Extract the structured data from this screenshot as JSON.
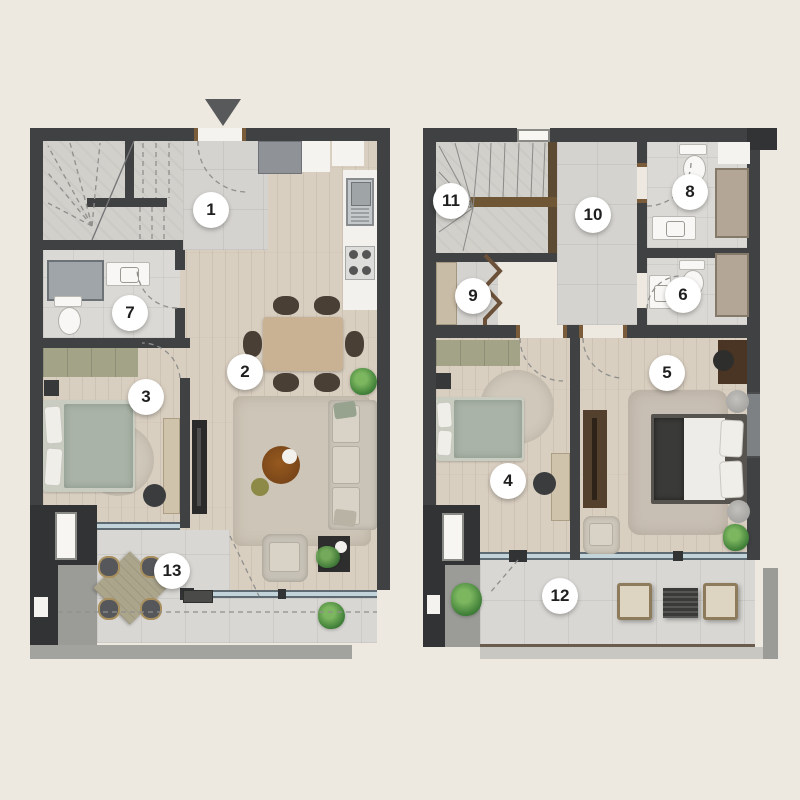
{
  "title": "Duplex apartment floor plans (two levels, rooms numbered 1-13)",
  "colors": {
    "background": "#EDE8E0",
    "wall": "#3F4142",
    "wall_dark": "#323335",
    "wood_floor": "#D9CFC1",
    "tile_floor": "#D5D3CF",
    "terrace_floor": "#D8D7D3",
    "window_glass": "#C2D3D9",
    "door_jamb_brown": "#7A5B3A",
    "stair_rail_brown": "#6F5635",
    "wardrobe_olive": "#A3A387",
    "bed_sage": "#A9B3A7",
    "plant_green": "#3F7E38",
    "badge_bg": "#FFFFFF",
    "badge_text": "#1F1F1F",
    "ledge_grey": "#A2A29E"
  },
  "entrance": {
    "marker_icon": "down-arrow"
  },
  "badges": {
    "r1": "1",
    "r2": "2",
    "r3": "3",
    "r4": "4",
    "r5": "5",
    "r6": "6",
    "r7": "7",
    "r8": "8",
    "r9": "9",
    "r10": "10",
    "r11": "11",
    "r12": "12",
    "r13": "13"
  },
  "plans": {
    "lower": {
      "id": "lower-floor-plan",
      "room_numbers": [
        "1",
        "2",
        "3",
        "7",
        "13"
      ],
      "features": [
        "entrance-arrow",
        "staircase-dashed",
        "entry-hall",
        "kitchen-counter",
        "kitchen-sink",
        "kitchen-hob",
        "entry-cabinet",
        "bathroom-shower",
        "bathroom-sink",
        "toilet",
        "dining-table-6-chairs",
        "sofa",
        "coffee-table",
        "armchair",
        "side-table",
        "tv-console",
        "wardrobe",
        "single-bed",
        "round-rug",
        "area-rug",
        "desk",
        "desk-chair",
        "balcony-table-4-chairs",
        "plants",
        "windows"
      ]
    },
    "upper": {
      "id": "upper-floor-plan",
      "room_numbers": [
        "4",
        "5",
        "6",
        "8",
        "9",
        "10",
        "11",
        "12"
      ],
      "features": [
        "staircase-solid",
        "stair-railing",
        "hallway",
        "closet-rod-zigzag",
        "closet-cabinet",
        "two-bathrooms",
        "toilets",
        "showers",
        "sinks",
        "wardrobe",
        "single-bed",
        "double-bed",
        "round-rug",
        "area-rug",
        "tv-console",
        "desks",
        "desk-chairs",
        "armchair",
        "poufs",
        "balcony-lounge-chairs",
        "outdoor-table",
        "plants",
        "windows"
      ]
    }
  }
}
